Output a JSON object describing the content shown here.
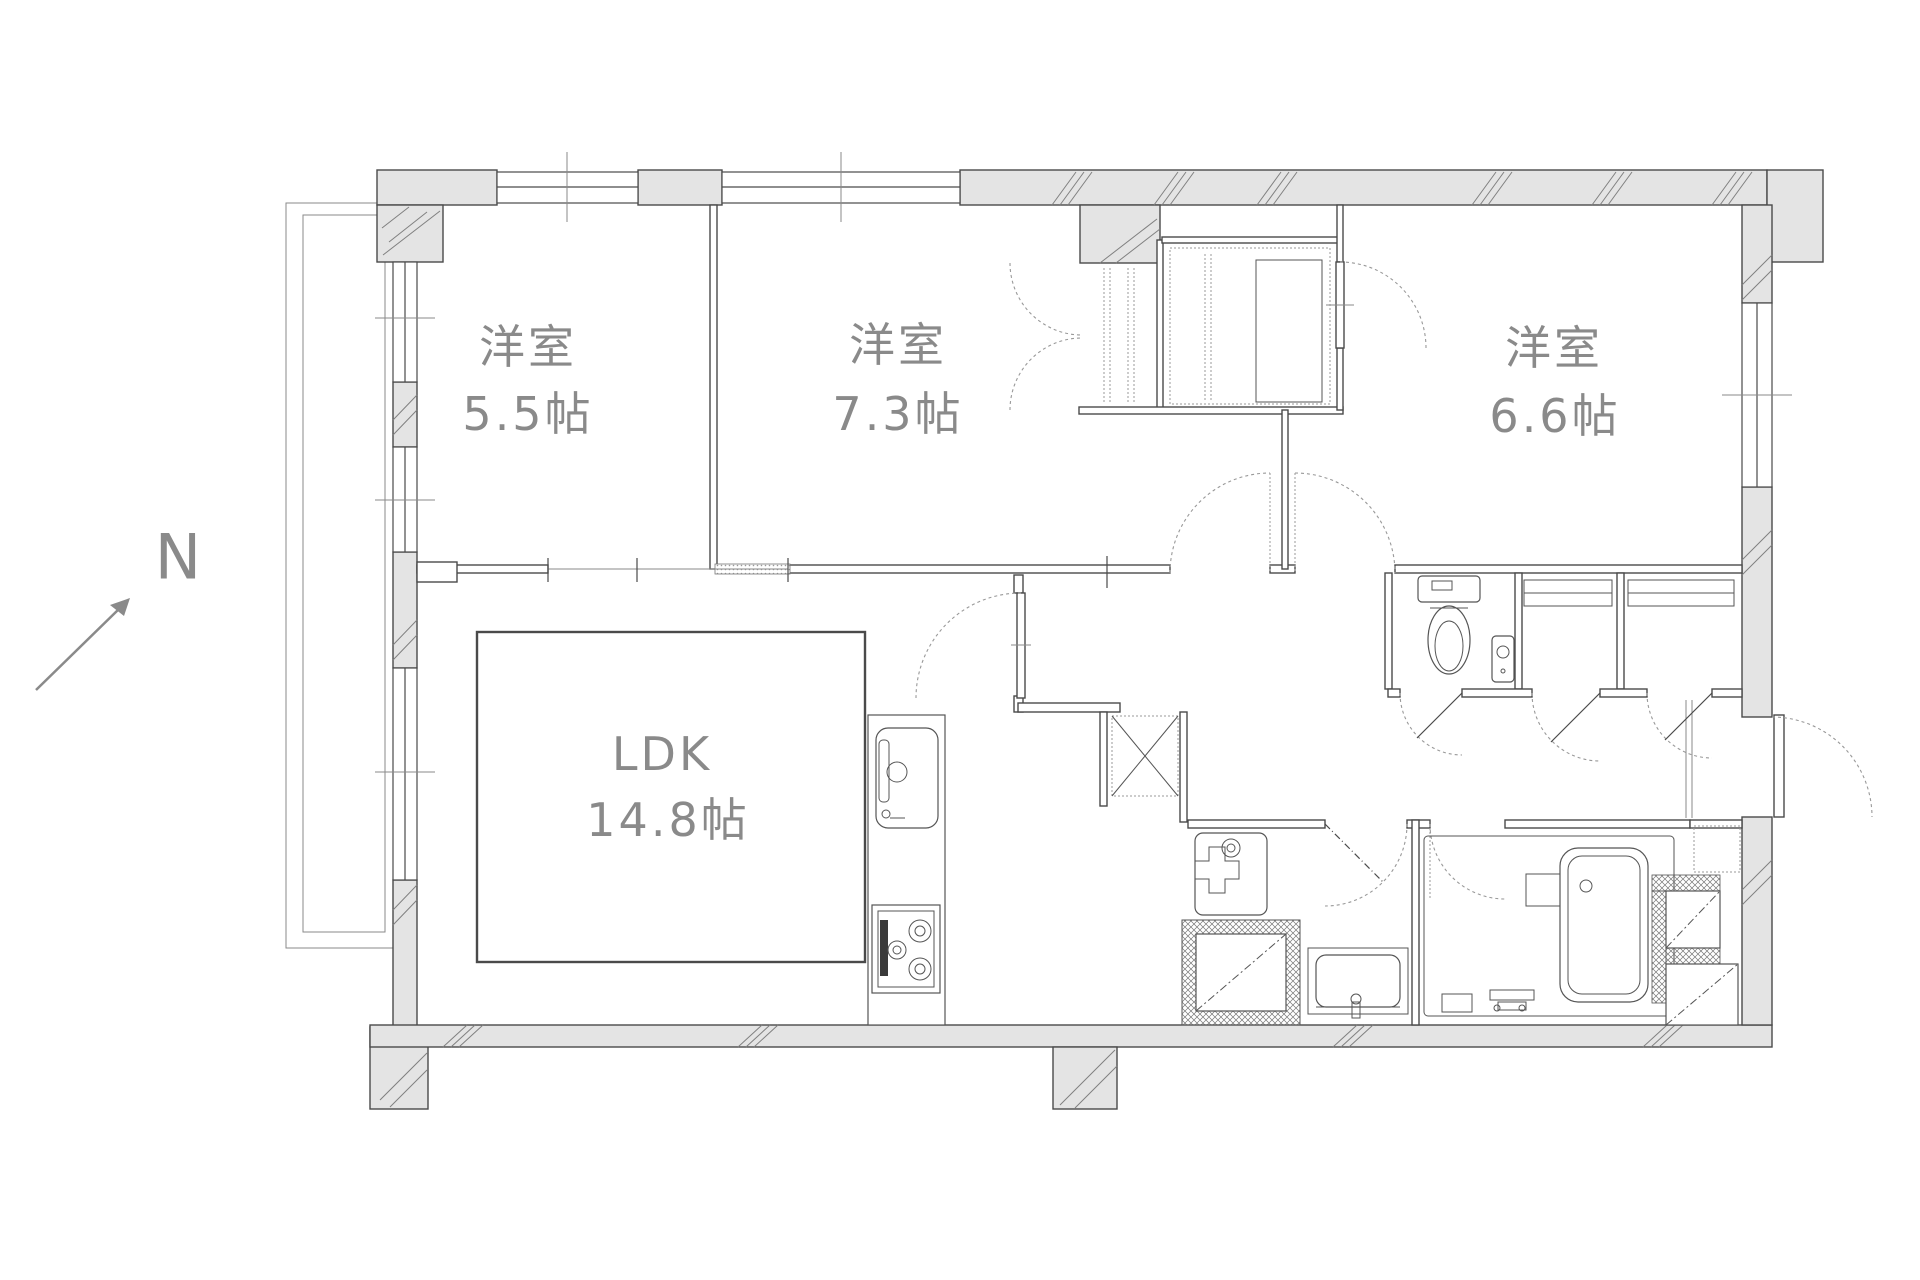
{
  "compass": {
    "label": "N"
  },
  "rooms": [
    {
      "id": "western-room-1",
      "name": "洋室",
      "size": "5.5帖"
    },
    {
      "id": "western-room-2",
      "name": "洋室",
      "size": "7.3帖"
    },
    {
      "id": "western-room-3",
      "name": "洋室",
      "size": "6.6帖"
    },
    {
      "id": "ldk",
      "name": "LDK",
      "size": "14.8帖"
    }
  ],
  "colors": {
    "wall_fill": "#e4e4e4",
    "wall_line": "#4a4a4a",
    "thin_line": "#8a8a8a",
    "label_text": "#8a8a8a",
    "background": "#ffffff"
  }
}
